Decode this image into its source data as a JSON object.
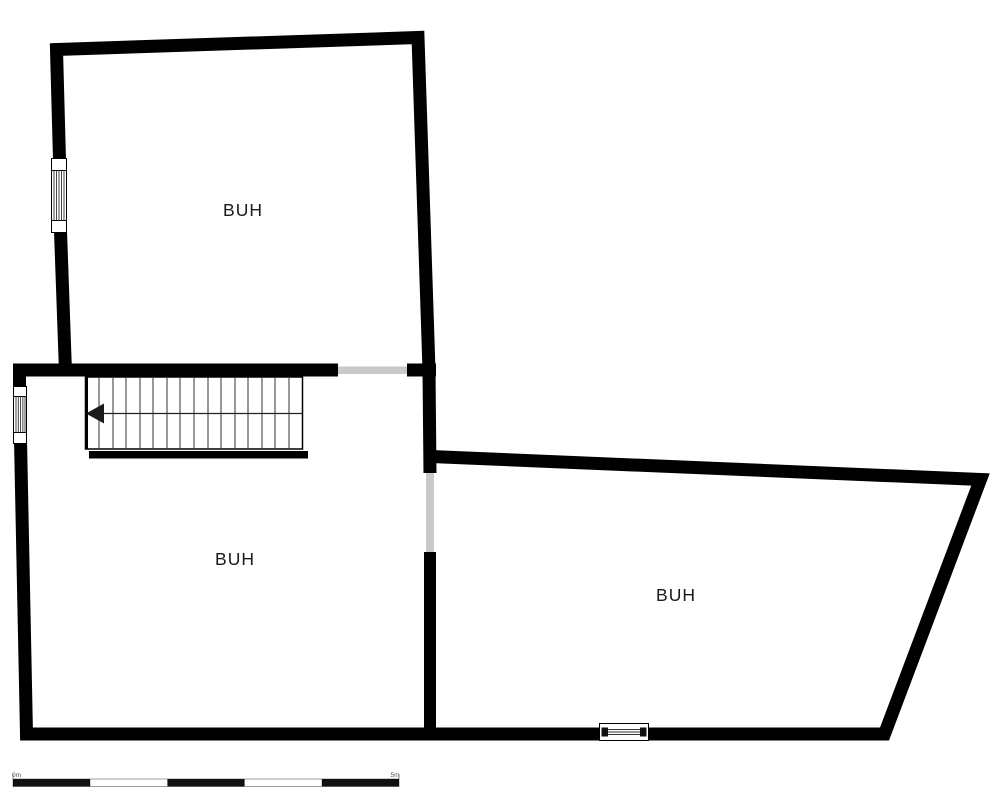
{
  "colors": {
    "background": "#ffffff",
    "wall": "#000000",
    "opening": "#c9c9c9",
    "label": "#1a1a1a"
  },
  "rooms": [
    {
      "name": "upper-room",
      "label": "BUH"
    },
    {
      "name": "lower-left-room",
      "label": "BUH"
    },
    {
      "name": "lower-right-room",
      "label": "BUH"
    }
  ],
  "stairs": {
    "treads": 16,
    "direction": "left"
  },
  "scale_bar": {
    "left_label": "0m",
    "right_label": "5m",
    "segments": 5
  }
}
